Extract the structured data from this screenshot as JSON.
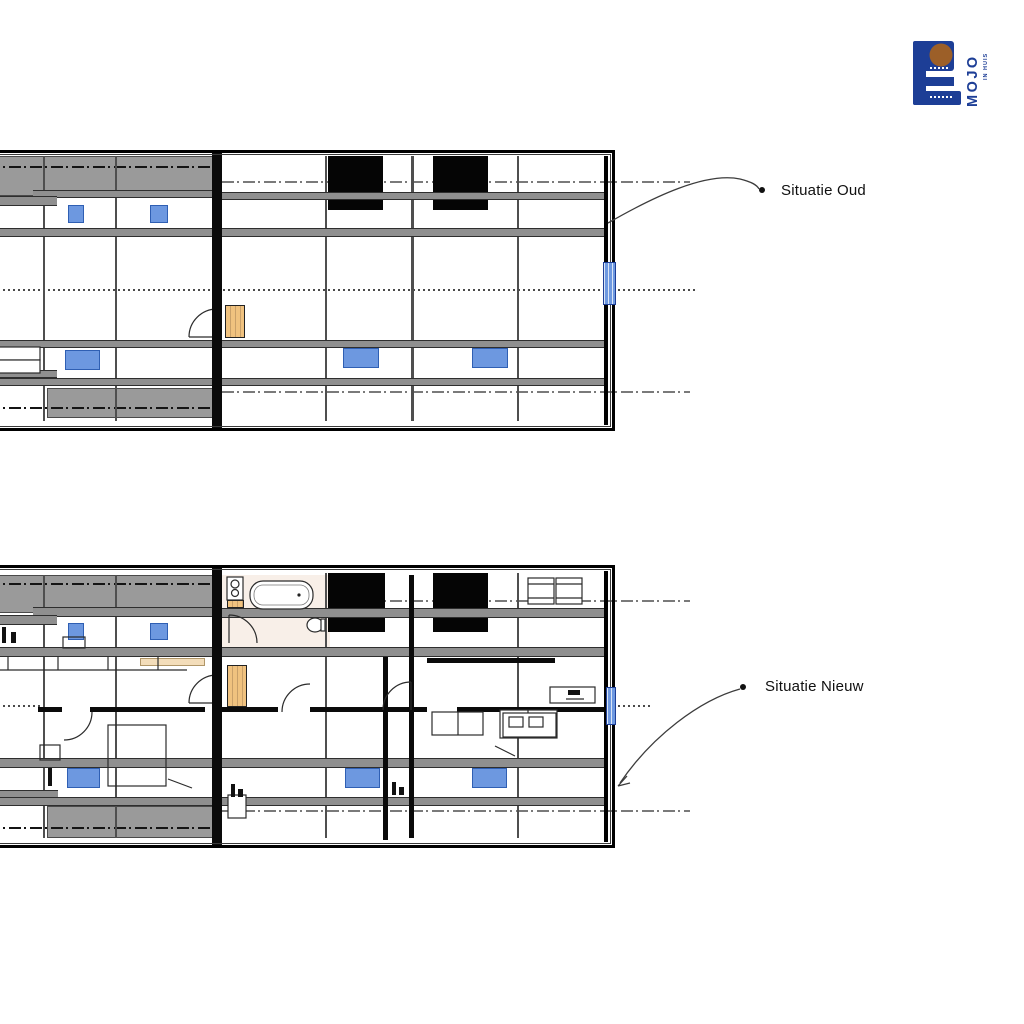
{
  "annotations": {
    "old_label": "Situatie Oud",
    "new_label": "Situatie Nieuw"
  },
  "logo": {
    "brand": "MOJO",
    "tagline": "IN HUIS"
  },
  "colors": {
    "accent_blue": "#6d98e0",
    "accent_blue_border": "#2f5fb3",
    "logo_blue": "#1d3e96",
    "logo_brown": "#9c5f28",
    "beam_gray": "#8f8f8f",
    "zone_gray": "#9a9a9a",
    "stairs_tan": "#f0c27f",
    "bath_pink": "#f8efe8"
  }
}
